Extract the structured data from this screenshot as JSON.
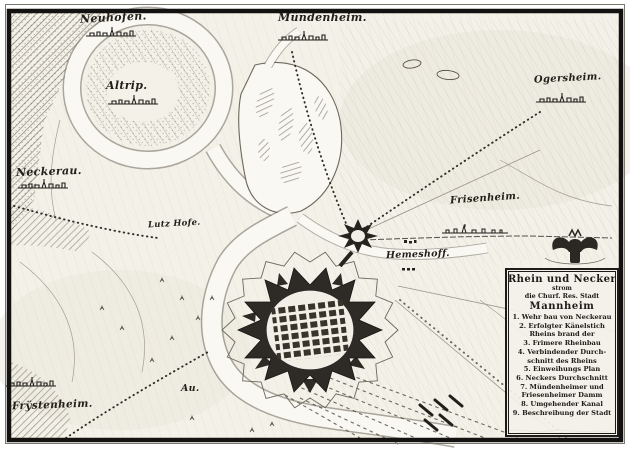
{
  "colors": {
    "paper": "#f3f1e8",
    "ink": "#1d1b17",
    "hatch": "#6f6a5e",
    "water_edge": "#6d685c"
  },
  "place_labels": {
    "neuhofen": "Neuhofen.",
    "muendenheim": "Mündenheim.",
    "altrip": "Altrip.",
    "neckerau": "Neckerau.",
    "ogersheim": "Ogersheim.",
    "frisenheim": "Frisenheim.",
    "hemeshoff": "Hemeshoff.",
    "lutzhofe": "Lutz Hofe.",
    "au": "Au.",
    "frystenheim": "Frÿstenheim."
  },
  "cartouche": {
    "lines": [
      "Rhein und Necker",
      "strom",
      "die Churf. Res. Stadt",
      "Mannheim",
      "1. Wehr bau von Neckerau",
      "2. Erfolgter Känelstich",
      "Rheins brand der",
      "3. Frimere Rheinbau",
      "4. Verbindender Durch-",
      "schnitt des Rheins",
      "5. Einweihungs Plan",
      "6. Neckers Durchschnitt",
      "7. Mündenheimer und",
      "Friesenheimer Damm",
      "8. Umgehender Kanal",
      "9. Beschreibung der Stadt"
    ]
  }
}
